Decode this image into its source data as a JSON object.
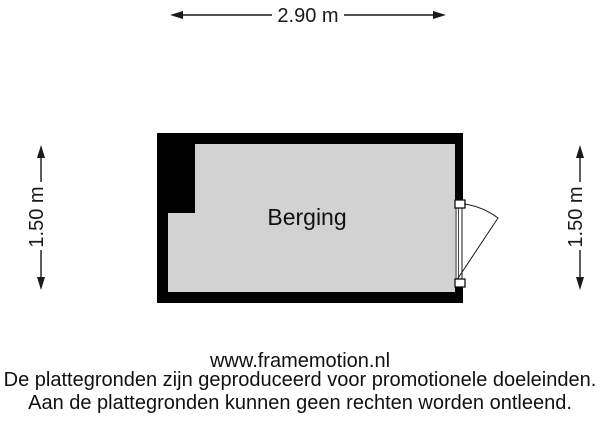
{
  "page": {
    "background": "#ffffff",
    "wall_color": "#000000",
    "floor_color": "#d2d2d2"
  },
  "dimensions": {
    "top": "2.90 m",
    "left": "1.50 m",
    "right": "1.50 m"
  },
  "room": {
    "label": "Berging"
  },
  "footer": {
    "website": "www.framemotion.nl",
    "disclaimer_line1": "De plattegronden zijn geproduceerd voor promotionele doeleinden.",
    "disclaimer_line2": "Aan de plattegronden kunnen geen rechten worden ontleend."
  }
}
